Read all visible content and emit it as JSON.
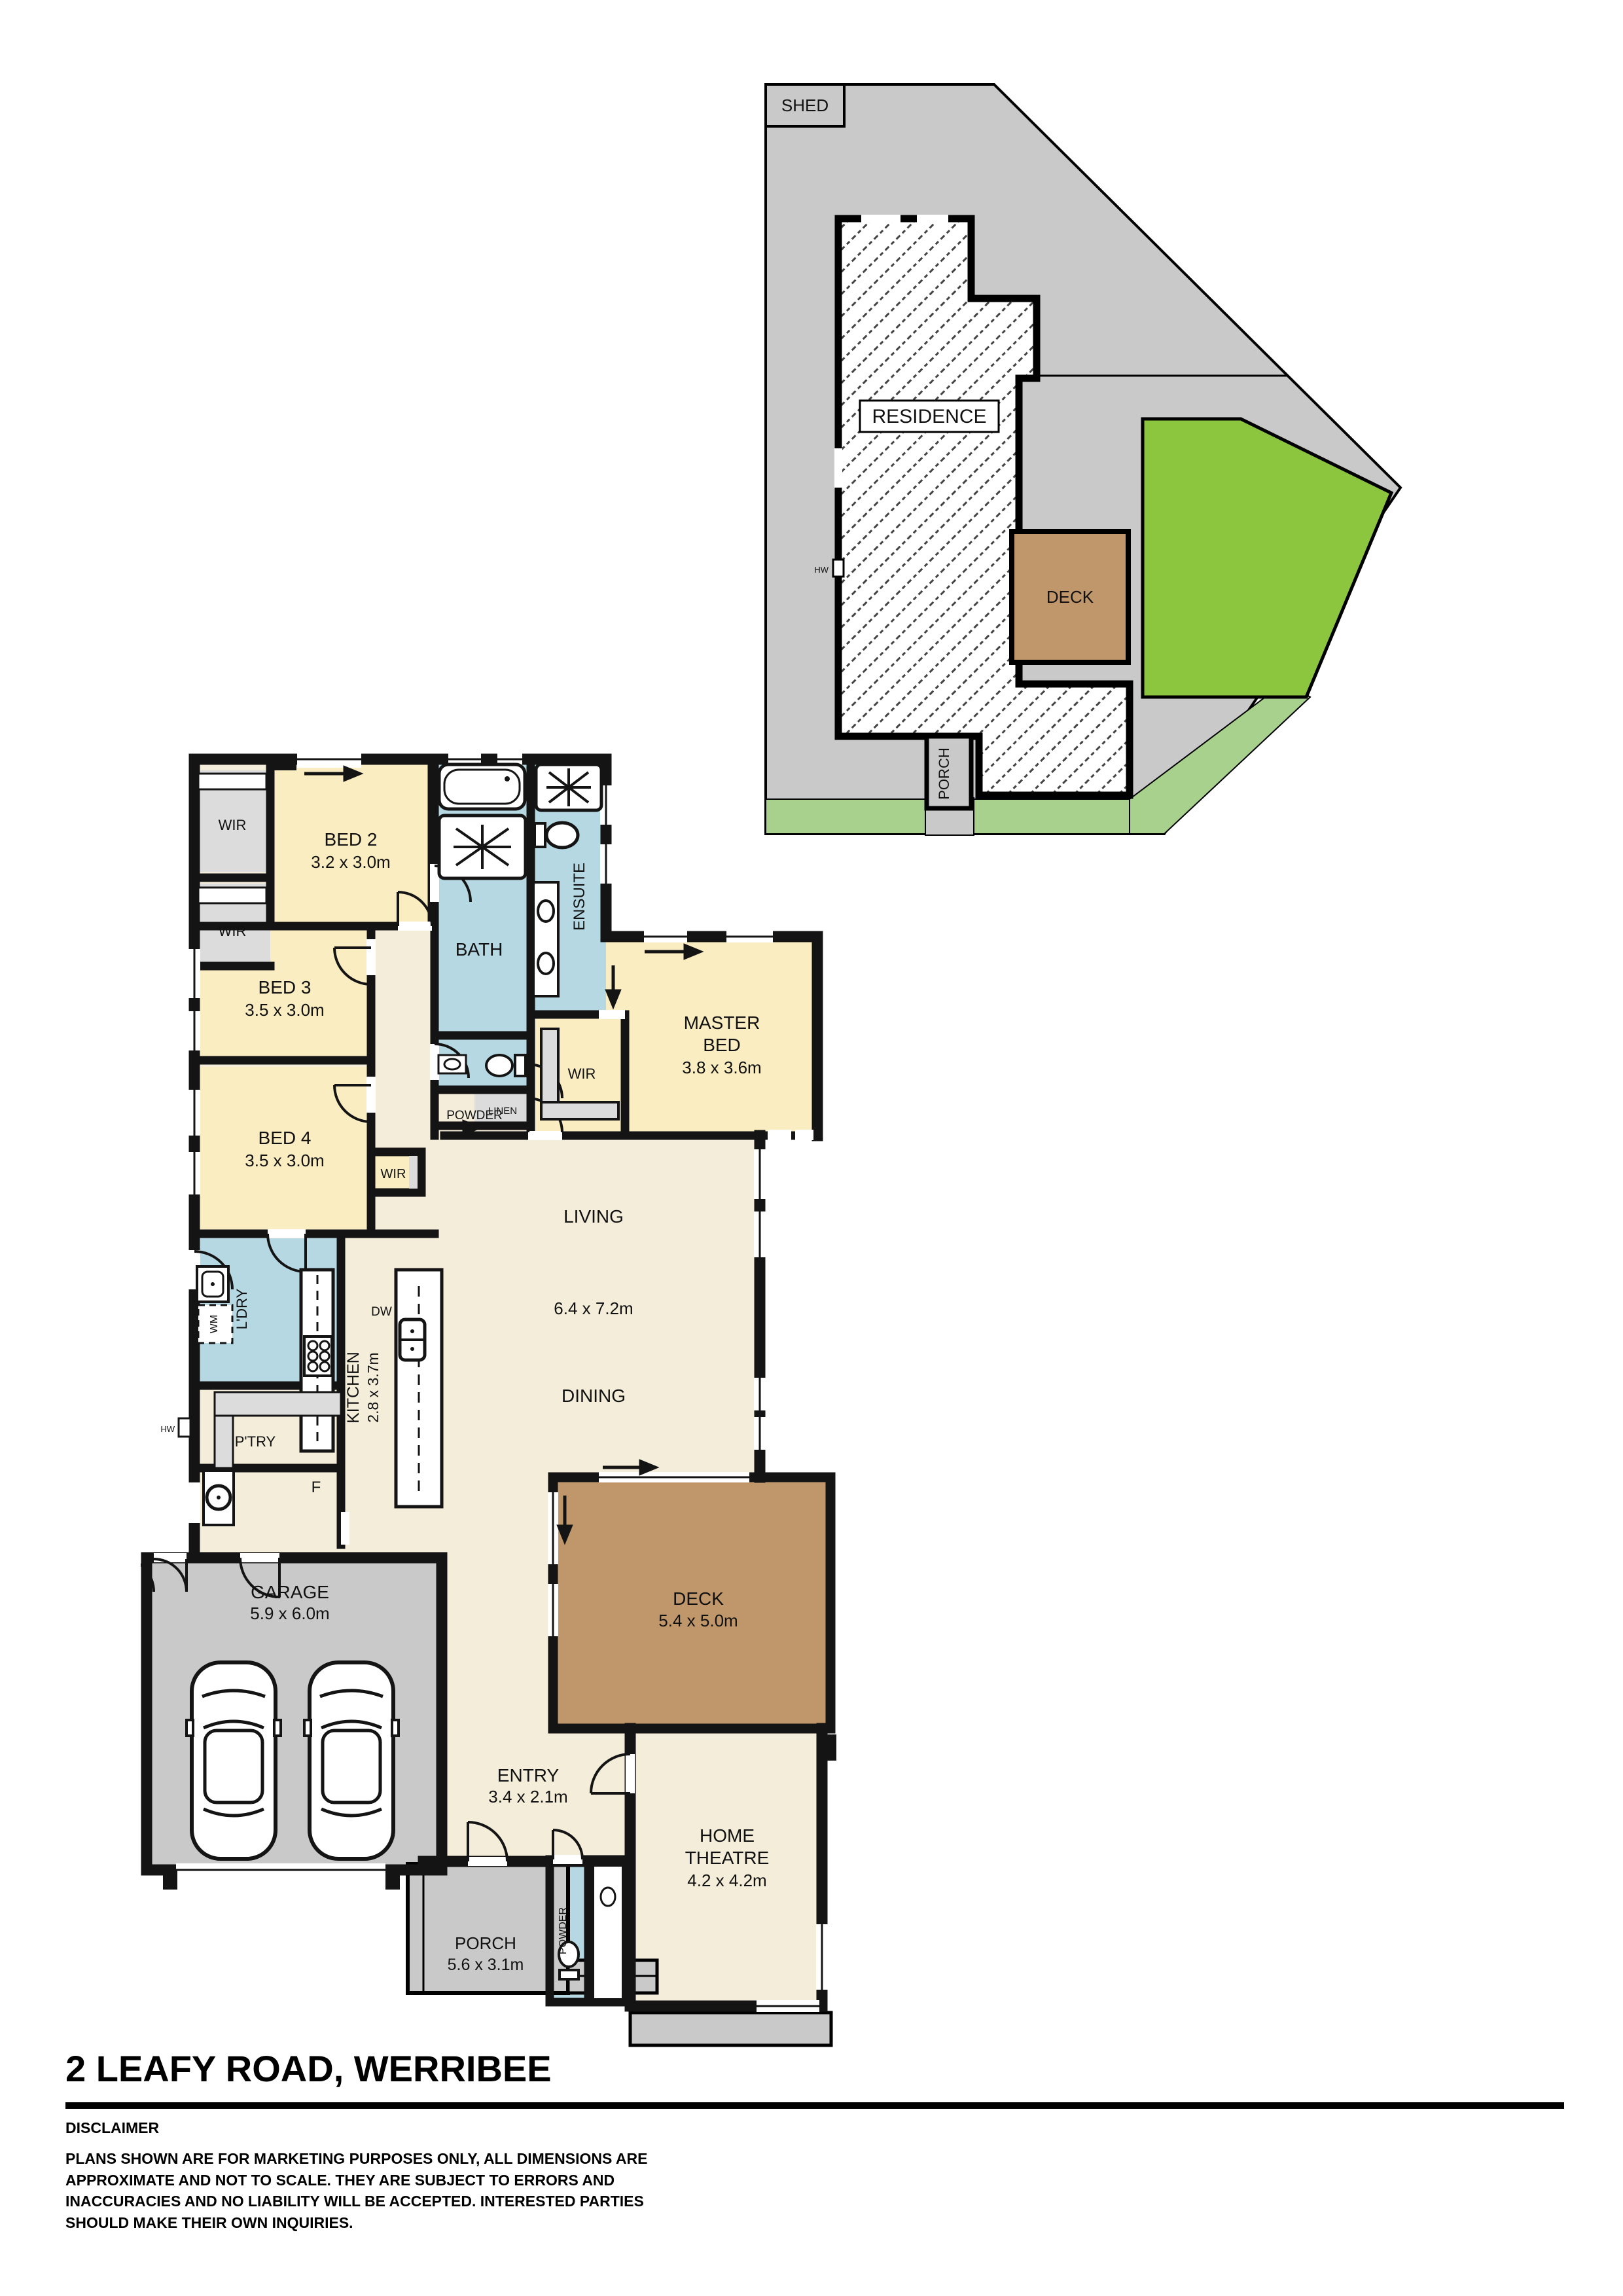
{
  "page": {
    "title": "2 LEAFY ROAD, WERRIBEE",
    "disclaimer_heading": "DISCLAIMER",
    "disclaimer_body": "PLANS SHOWN ARE FOR MARKETING PURPOSES ONLY, ALL DIMENSIONS ARE APPROXIMATE AND NOT TO SCALE. THEY ARE SUBJECT  TO ERRORS AND INACCURACIES AND NO LIABILITY WILL BE ACCEPTED. INTERESTED PARTIES SHOULD MAKE THEIR OWN INQUIRIES."
  },
  "site_plan": {
    "shed": "SHED",
    "residence": "RESIDENCE",
    "deck": "DECK",
    "porch": "PORCH",
    "hw": "HW"
  },
  "floor_plan": {
    "wir": "WIR",
    "bed2": {
      "name": "BED 2",
      "dims": "3.2 x 3.0m"
    },
    "bed3": {
      "name": "BED 3",
      "dims": "3.5 x 3.0m"
    },
    "bed4": {
      "name": "BED 4",
      "dims": "3.5 x 3.0m"
    },
    "master": {
      "line1": "MASTER",
      "line2": "BED",
      "dims": "3.8 x 3.6m"
    },
    "bath": "BATH",
    "ensuite": "ENSUITE",
    "powder": "POWDER",
    "linen": "LINEN",
    "living": "LIVING",
    "living_dims": "6.4 x 7.2m",
    "dining": "DINING",
    "kitchen": {
      "name": "KITCHEN",
      "dims": "2.8 x 3.7m"
    },
    "ldry": "L'DRY",
    "wm": "WM",
    "dw": "DW",
    "hw": "HW",
    "ptry": "P'TRY",
    "fridge": "F",
    "garage": {
      "name": "GARAGE",
      "dims": "5.9 x 6.0m"
    },
    "deck": {
      "name": "DECK",
      "dims": "5.4 x 5.0m"
    },
    "entry": {
      "name": "ENTRY",
      "dims": "3.4 x 2.1m"
    },
    "theatre": {
      "line1": "HOME",
      "line2": "THEATRE",
      "dims": "4.2 x 4.2m"
    },
    "porch": {
      "name": "PORCH",
      "dims": "5.6 x 3.1m"
    }
  },
  "colors": {
    "room_yellow": "#FAEDC2",
    "room_blue": "#B5D8E2",
    "room_cream": "#F3EDDA",
    "room_gray": "#DCDCDC",
    "site_gray": "#C9C9C9",
    "deck_brown": "#C0966B",
    "lawn_green": "#8CC63E",
    "path_green": "#A9D18E",
    "wall_black": "#141414"
  }
}
